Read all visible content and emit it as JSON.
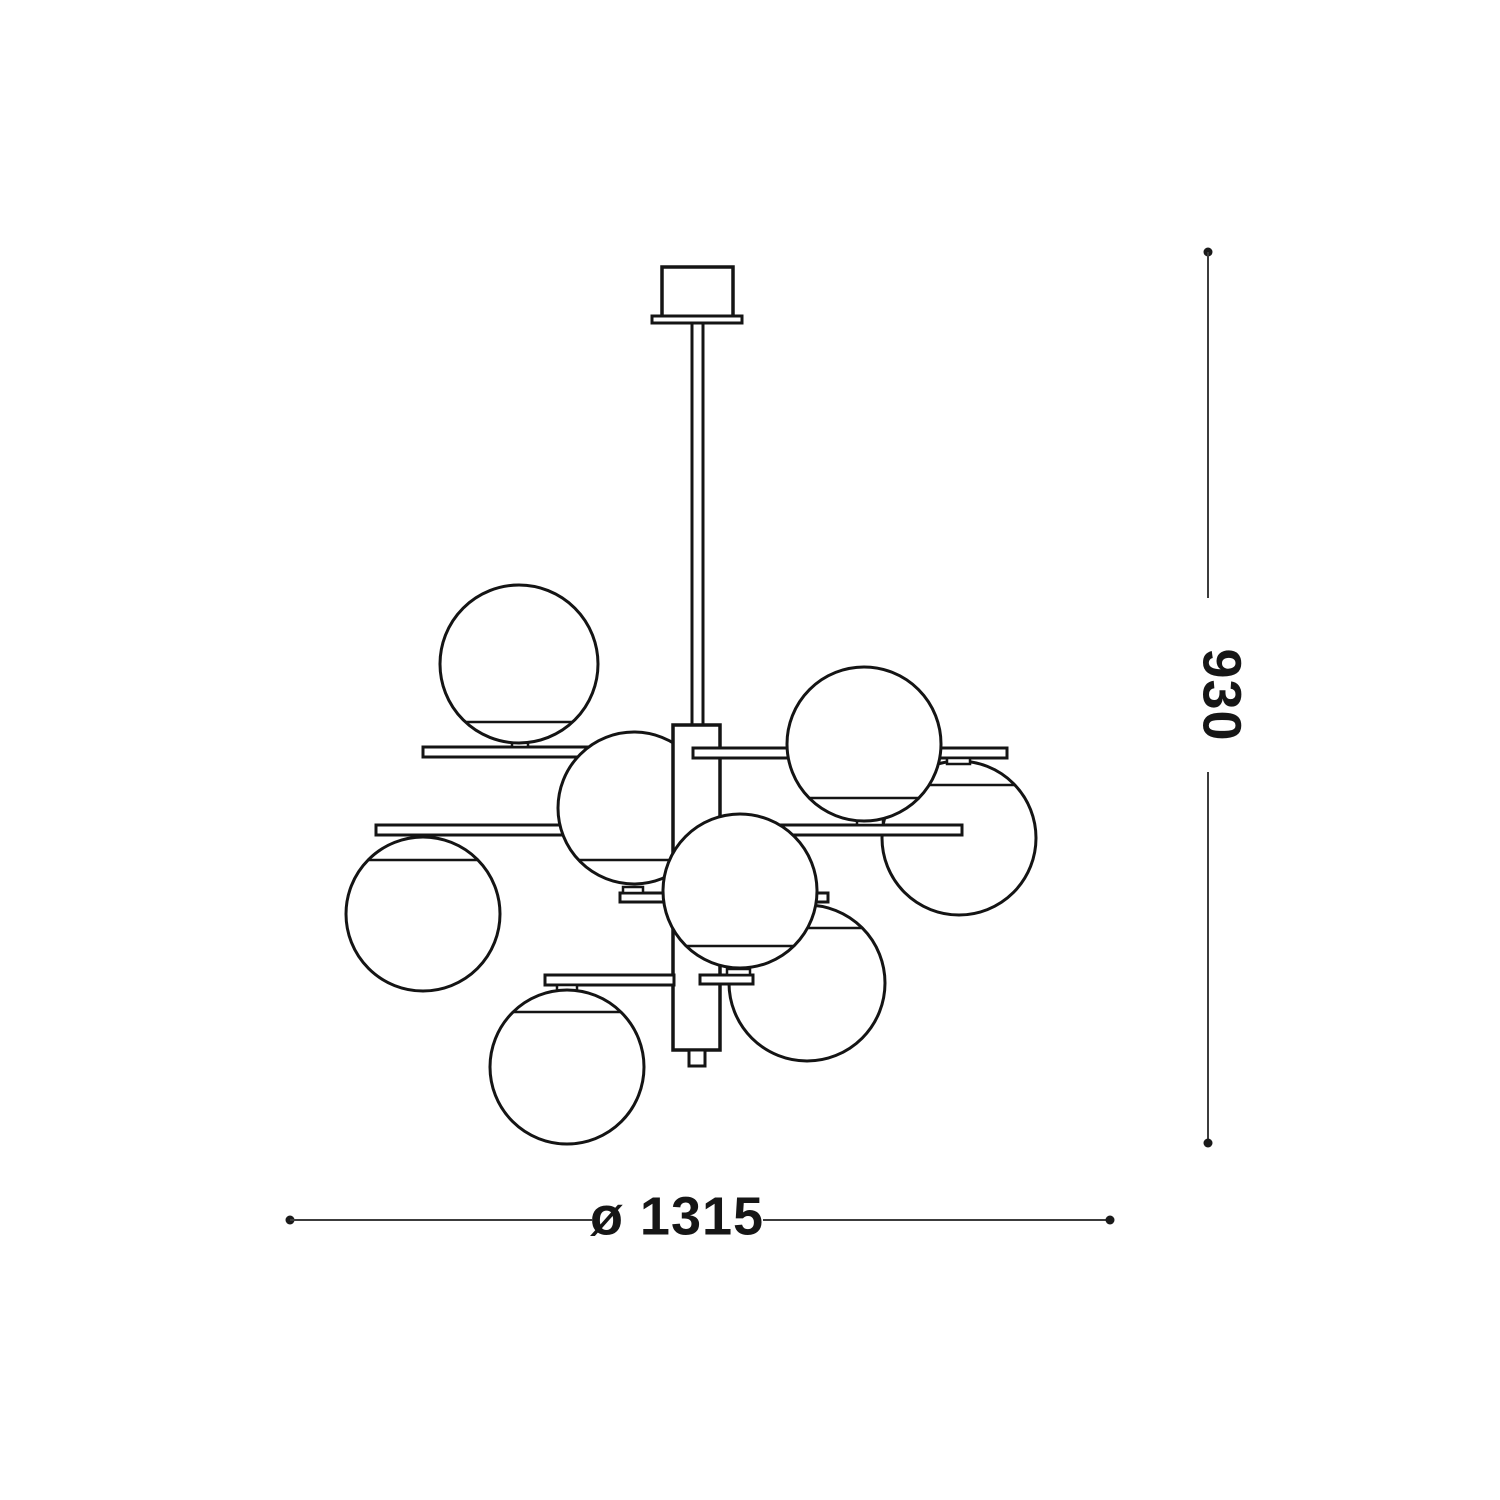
{
  "figure": {
    "description": "Technical dimension line drawing of an 8-globe chandelier pendant lamp (side view)",
    "globe_count": 8
  },
  "dimensions": {
    "height_label": "930",
    "diameter_label": "ø 1315"
  },
  "colors": {
    "ink": "#141414",
    "dimension_line": "#3c3c3c",
    "text": "#161616",
    "background": "#ffffff"
  }
}
